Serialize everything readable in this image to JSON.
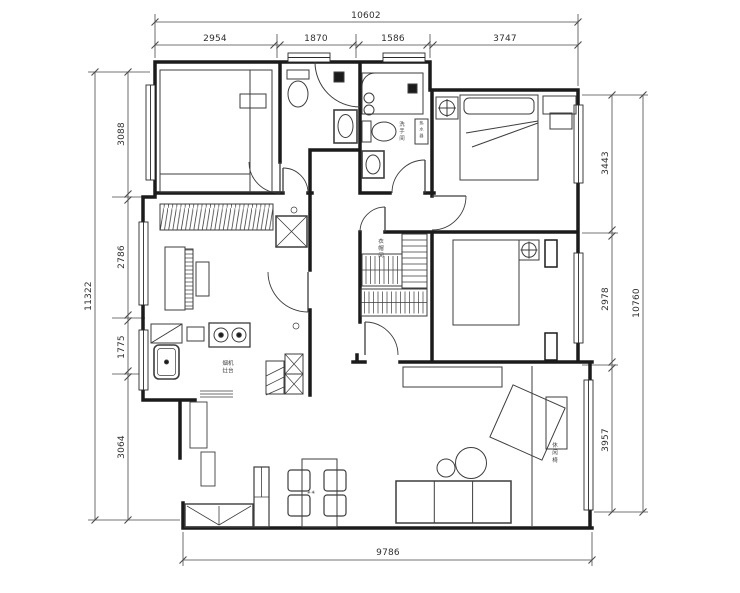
{
  "title": "apartment-floor-plan",
  "dimensions": {
    "top": {
      "total": "10602",
      "segments": [
        "2954",
        "1870",
        "1586",
        "3747"
      ]
    },
    "left": {
      "total": "11322",
      "segments": [
        "3088",
        "2786",
        "1775",
        "3064"
      ]
    },
    "right": {
      "total": "10760",
      "segments": [
        "3443",
        "2978",
        "3957"
      ]
    },
    "bottom": {
      "total": "9786"
    }
  },
  "annotations": {
    "bathroom": "洗手间",
    "water_heater": "热水器",
    "kitchen_hood": "烟机",
    "kitchen_stove": "灶台",
    "closet": "衣帽间",
    "lounge": "休闲椅",
    "table_decor": "✳✳"
  },
  "colors": {
    "wall": "#1b1b1b",
    "furniture": "#3d3d3d",
    "dimension": "#4a4a4a",
    "background": "#ffffff"
  }
}
